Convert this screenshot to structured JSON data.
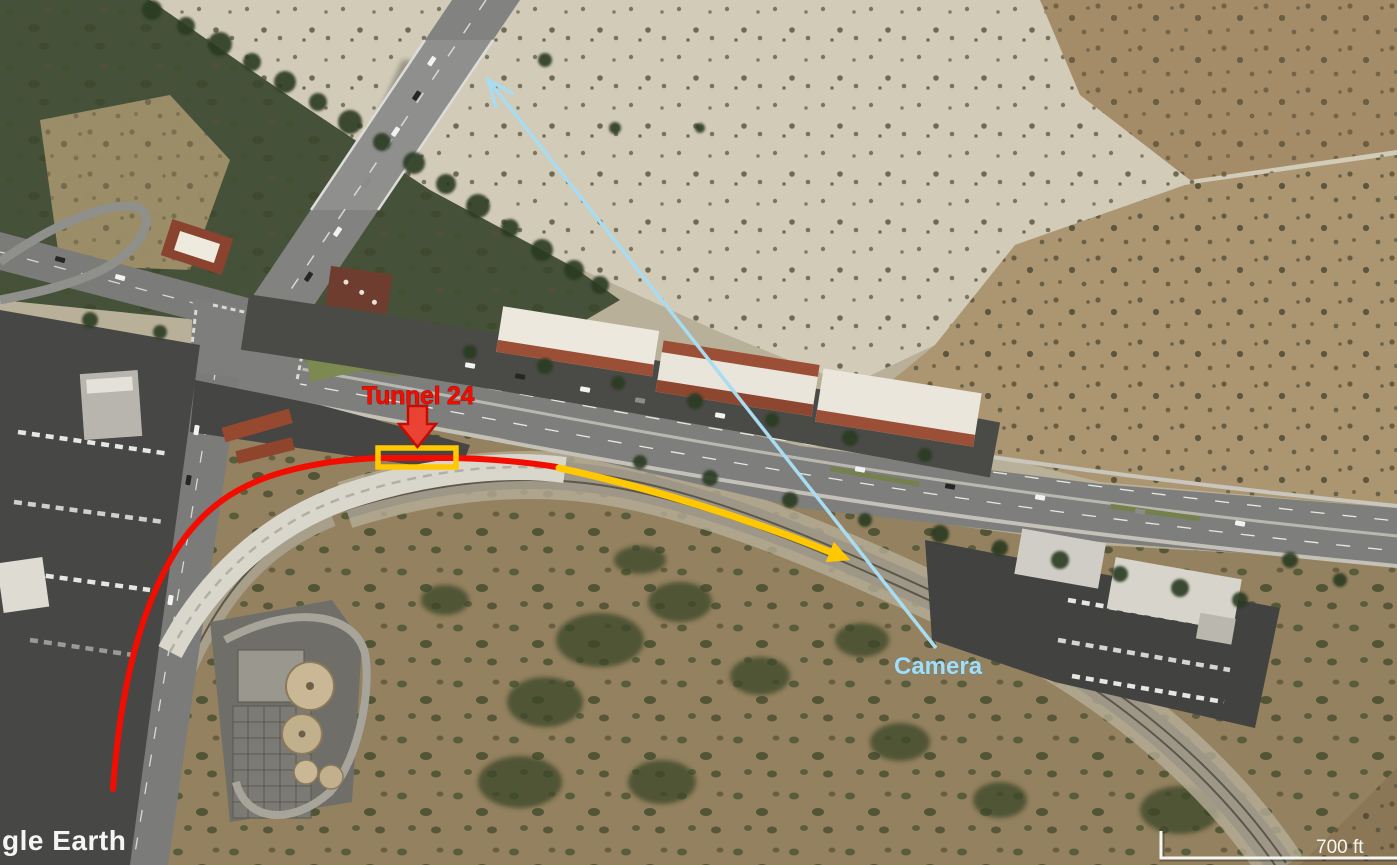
{
  "map": {
    "type": "annotated-satellite-image",
    "scene": "aerial view of desert wash, freeway bridge, shopping centers, curved railroad through hills"
  },
  "palette": {
    "ann-red": "#f20d00",
    "ann-yellow": "#ffc800",
    "ann-cyan": "#a8dcf0",
    "ann-white": "#f5f5f2"
  },
  "annotations": {
    "tunnel": {
      "label": "Tunnel 24",
      "color": "#f20d00",
      "box_color": "#ffc800",
      "pointer": "block-arrow-down"
    },
    "camera": {
      "label": "Camera",
      "color": "#a8dcf0",
      "pointer": "sightline-arrow-up-left"
    },
    "track": {
      "red_segment_color": "#f20d00",
      "yellow_segment_color": "#ffc800",
      "yellow_segment_pointer": "curved-arrow-right"
    }
  },
  "scale_bar": {
    "label": "700 ft",
    "color": "#f5f5f2"
  },
  "watermark": {
    "text": "gle Earth",
    "color": "#ffffff"
  }
}
